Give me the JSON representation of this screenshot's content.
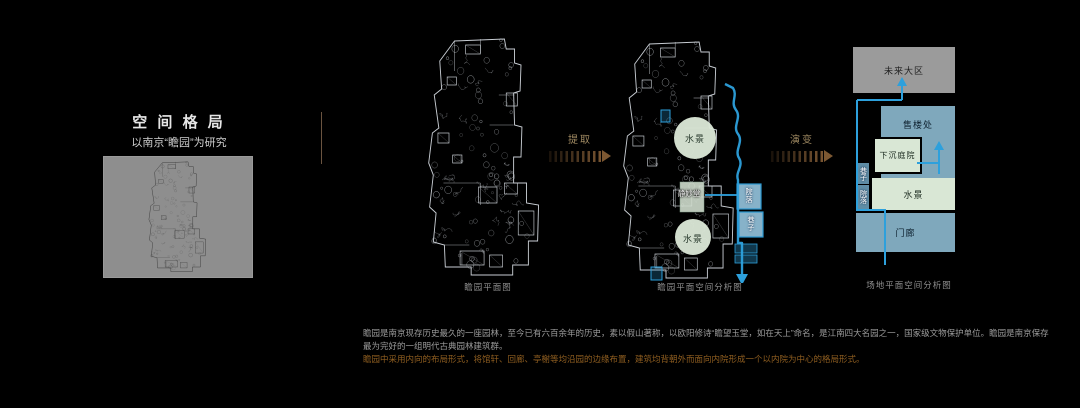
{
  "header": {
    "title": "空 间 格 局",
    "subtitle": "以南京“瞻园”为研究"
  },
  "arrow1": {
    "label": "提取"
  },
  "arrow2": {
    "label": "演变"
  },
  "d1": {
    "caption": "瞻园平面图"
  },
  "d2": {
    "caption": "瞻园平面空间分析图",
    "labels": {
      "water_top": "水景",
      "water_bottom": "水景",
      "hall": "静妙堂",
      "box_right_top": "院落",
      "box_right_bottom": "巷子"
    }
  },
  "d3": {
    "caption": "场地平面空间分析图",
    "boxes": {
      "future": "未来大区",
      "sales": "售楼处",
      "sunken": "下沉庭院",
      "water": "水景",
      "porch": "门廊",
      "alley": "巷子",
      "courtyard": "院落"
    }
  },
  "footer": {
    "line1": "瞻园是南京现存历史最久的一座园林，至今已有六百余年的历史，素以假山著称，以欧阳修诗“瞻望玉堂，如在天上”命名，是江南四大名园之一，国家级文物保护单位。瞻园是南京保存",
    "line2": "最为完好的一组明代古典园林建筑群。",
    "line3": "瞻园中采用内向的布局形式，将馆轩、回廊、亭榭等均沿园的边缘布置，建筑均背朝外而面向内院形成一个以内院为中心的格局形式。"
  },
  "colors": {
    "accent_blue": "#2da0dc",
    "pale_green": "#d9e7d5",
    "box_blue": "#7fa8bc",
    "gray_box": "#9b9b9b",
    "bronze_arrow": "#7a5632",
    "footer_accent": "#8f5e20",
    "plan_line": "#c8cdd3"
  }
}
